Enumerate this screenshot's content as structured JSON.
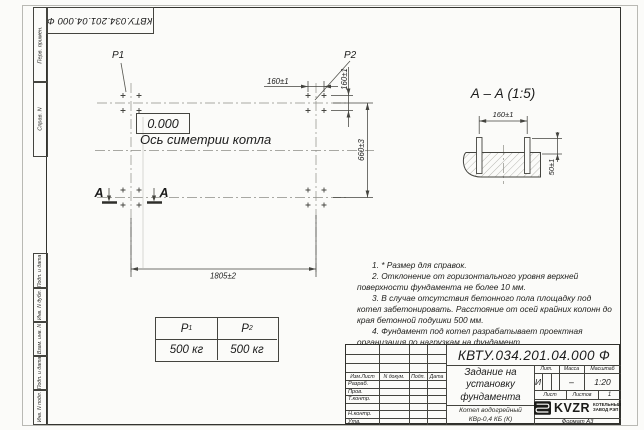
{
  "page": {
    "designation": "КВТУ.034.201.04.000  Ф",
    "format": "Формат А3"
  },
  "margin_labels": {
    "perv_primen": "Перв. примен.",
    "sprav_n": "Справ. N",
    "podp_data_1": "Подп. и дата",
    "inv_dubl": "Инв. N дубл.",
    "vzam_inv": "Взам. инв. N",
    "podp_data_2": "Подп. и дата",
    "inv_podl": "Инв. N подл."
  },
  "plan": {
    "p1_label": "P1",
    "p2_label": "P2",
    "level_mark": "0.000",
    "axis_label": "Ось симетрии котла",
    "section_letter": "А",
    "dims": {
      "bolt_spacing_x": "160±1",
      "bolt_spacing_y": "160±1",
      "row_spacing": "660±3",
      "length": "1805±2"
    }
  },
  "section": {
    "title": "А – А (1:5)",
    "dim_width": "160±1",
    "dim_height": "50±1"
  },
  "loads_table": {
    "headers": [
      {
        "base": "P",
        "sub": "1"
      },
      {
        "base": "P",
        "sub": "2"
      }
    ],
    "values": [
      "500 кг",
      "500 кг"
    ]
  },
  "notes": [
    "1. * Размер для справок.",
    "2. Отклонение от горизонтального уровня верхней поверхности фундамента не более 10 мм.",
    "3. В случае отсутствия бетонного пола площадку под котел забетонировать. Расстояние от осей крайних колонн до края бетонной подушки 500 мм.",
    "4. Фундамент под котел разрабатывает проектная организация по нагрузкам на фундамент."
  ],
  "title_block": {
    "doc_title_line1": "Задание на",
    "doc_title_line2": "установку",
    "doc_title_line3": "фундамента",
    "product_line1": "Котел водогрейный",
    "product_line2": "КВр-0,4  КБ  (К)",
    "rev_headers": [
      "Изм.Лист",
      "N докум.",
      "Подп.",
      "Дата"
    ],
    "row_labels": [
      "Разраб.",
      "Пров.",
      "Т.контр.",
      "",
      "Н.контр.",
      "Утв."
    ],
    "lit_header": "Лит.",
    "mass_header": "Масса",
    "scale_header": "Масштаб",
    "lit_value": "И",
    "mass_value": "–",
    "scale_value": "1:20",
    "sheet_label": "Лист",
    "sheets_label": "Листов",
    "sheets_value": "1",
    "logo_text": "KVZR",
    "logo_sub1": "КОТЕЛЬНЫЙ",
    "logo_sub2": "ЗАВОД РЭП"
  }
}
